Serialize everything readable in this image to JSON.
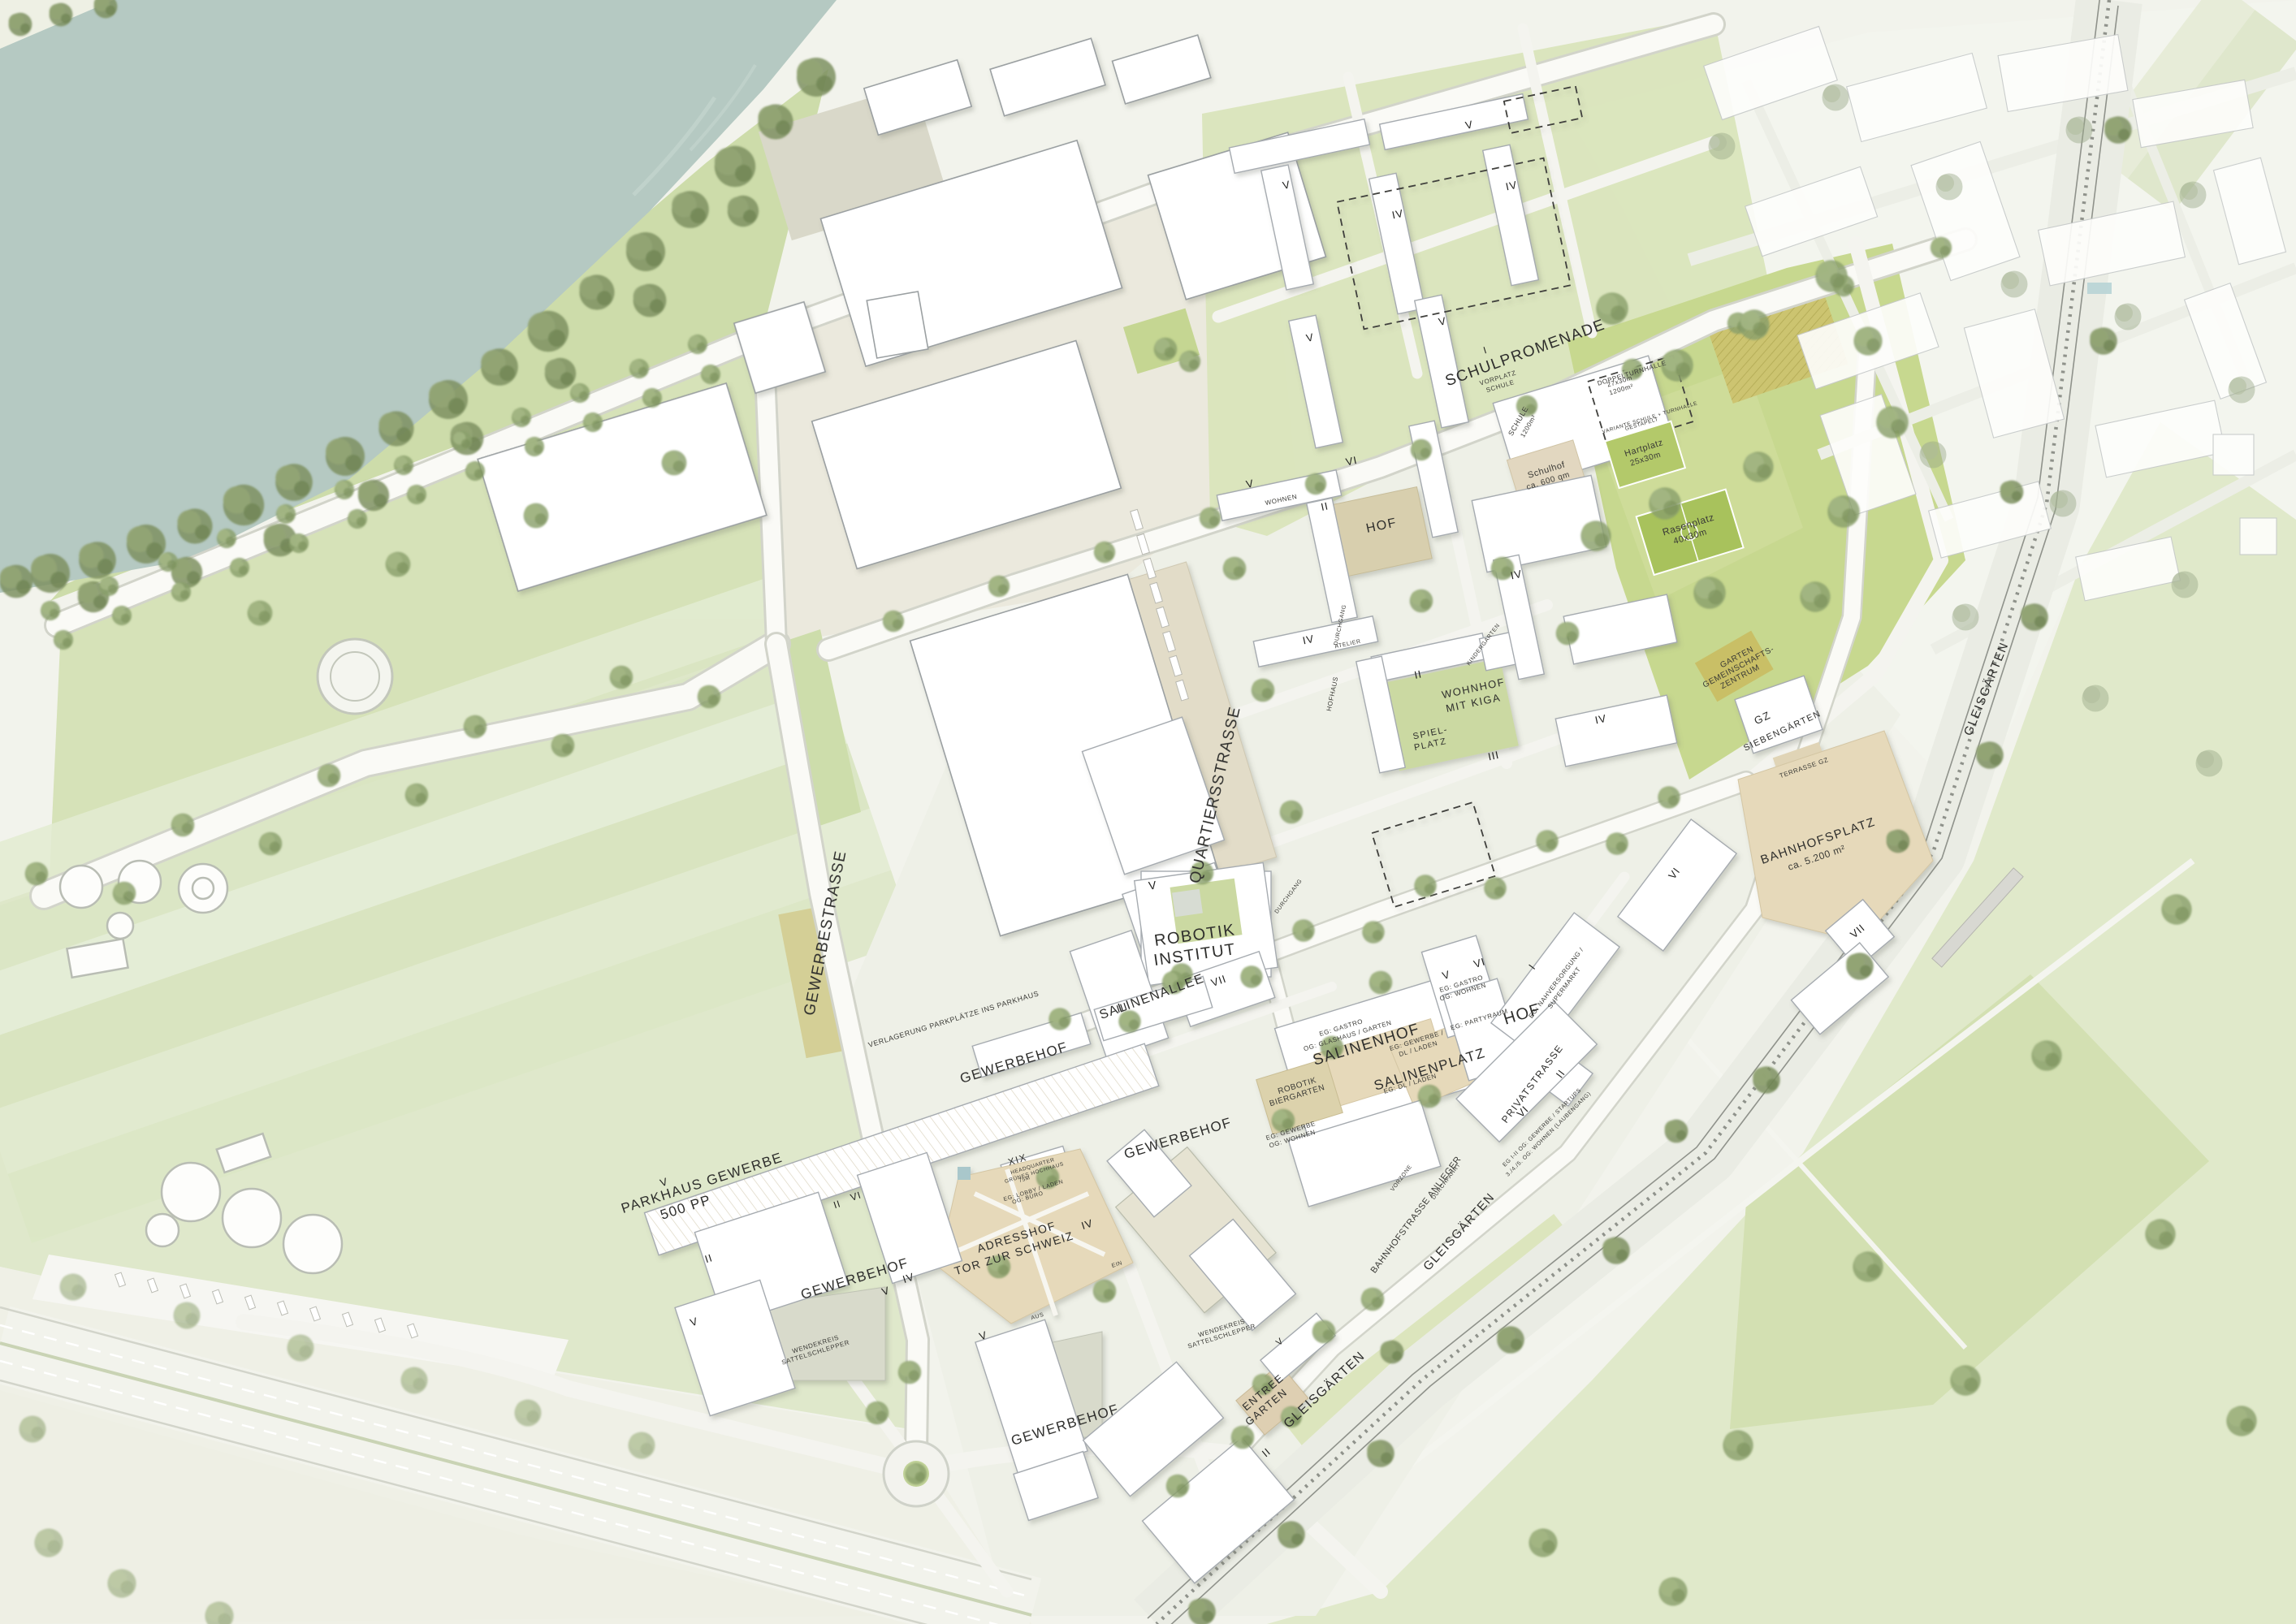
{
  "map_title": "Masterplan Gewerbe- und Wohnquartier",
  "colors": {
    "water": "#b5c9c2",
    "park": "#c7d88f",
    "field": "#dfe8cb",
    "turf": "#a8c25c",
    "plaza": "#e6d9ba",
    "building": "#ffffff",
    "tree": "#8aa06b",
    "rail_band": "#eaece4"
  },
  "labels": {
    "streets": {
      "gewerbestrasse": "GEWERBESTRASSE",
      "quartiersstrasse": "QUARTIERSSTRASSE",
      "schulpromenade": "SCHULPROMENADE",
      "salinenallee": "SALINENALLEE",
      "privatstrasse": "PRIVATSTRASSE",
      "bahnhofstrasse": "BAHNHOFSTRASSE ANLIEGER",
      "gleisgaerten": "GLEISGÄRTEN"
    },
    "areas": {
      "robotik1": "ROBOTIK",
      "robotik2": "INSTITUT",
      "salinenhof": "SALINENHOF",
      "salinenplatz": "SALINENPLATZ",
      "hof": "HOF",
      "gewerbehof": "GEWERBEHOF",
      "parkhaus1": "PARKHAUS GEWERBE",
      "parkhaus2": "500 PP",
      "wendekreis1": "WENDEKREIS",
      "wendekreis2": "SATTELSCHLEPPER",
      "adresshof1": "ADRESSHOF",
      "adresshof2": "TOR ZUR SCHWEIZ",
      "entree1": "ENTREE",
      "entree2": "GARTEN",
      "wohnhof1": "WOHNHOF",
      "wohnhof2": "MIT KIGA",
      "spielplatz1": "SPIEL-",
      "spielplatz2": "PLATZ",
      "biergarten1": "ROBOTIK",
      "biergarten2": "BIERGARTEN",
      "gz1": "GZ",
      "gz2": "SIEBENGÄRTEN",
      "gartengz1": "GARTEN",
      "gartengz2": "GEMEINSCHAFTS-",
      "gartengz3": "ZENTRUM",
      "terrasse": "TERRASSE GZ",
      "bahnhofsplatz1": "BAHNHOFSPLATZ",
      "bahnhofsplatz2": "ca. 5.200 m²",
      "hq1": "XIX",
      "hq2": "HEADQUARTER",
      "hq3": "GRÜNES HOCHHAUS",
      "hq4": "75M",
      "hq5": "EG: LOBBY / LADEN",
      "hq6": "OG: BÜRO"
    },
    "school": {
      "schule1": "SCHULE",
      "schule2": "1200m²",
      "turnhalle1": "DOPPELTURNHALLE",
      "turnhalle2": "27x30m",
      "turnhalle3": "1200m²",
      "variante1": "VARIANTE SCHULE + TURNHALLE",
      "variante2": "GESTAPELT",
      "vorplatz1": "VORPLATZ",
      "vorplatz2": "SCHULE",
      "schulhof1": "Schulhof",
      "schulhof2": "ca. 600 qm",
      "hartplatz1": "Hartplatz",
      "hartplatz2": "25x30m",
      "rasenplatz1": "Rasenplatz",
      "rasenplatz2": "40x30m"
    },
    "uses": {
      "gastro_glashaus1": "EG: GASTRO",
      "gastro_glashaus2": "OG: GLASHAUS / GARTEN",
      "gastro_wohnen1": "EG: GASTRO",
      "gastro_wohnen2": "OG: WOHNEN",
      "gewerbe_wohnen1": "EG: GEWERBE",
      "gewerbe_wohnen2": "OG: WOHNEN",
      "gewerbe_laden1": "EG: GEWERBE /",
      "gewerbe_laden2": "DL / LADEN",
      "dl_laden": "EG: DL / LADEN",
      "partyraum": "EG: PARTYRAUM",
      "nahversorgung1": "EG: NAHVERSORGUNG /",
      "nahversorgung2": "SUPERMARKT",
      "startups1": "EG I-II OG: GEWERBE / STARTUPS",
      "startups2": "3./4./5. OG: WOHNEN (LAUBENGANG)",
      "wohnen": "WOHNEN",
      "atelier": "ATELIER",
      "kindergarten": "KINDERGARTEN",
      "hofhaus": "HOFHAUS",
      "durchgang": "DURCHGANG",
      "durchfahrt": "DURCHFAHRT",
      "vorzone": "VORZONE",
      "verlagerung": "VERLAGERUNG PARKPLÄTZE INS PARKHAUS",
      "ein": "EIN",
      "aus": "AUS"
    },
    "storeys": {
      "i": "I",
      "ii": "II",
      "iii": "III",
      "iv": "IV",
      "v": "V",
      "vi": "VI",
      "vii": "VII",
      "xix": "XIX"
    }
  }
}
